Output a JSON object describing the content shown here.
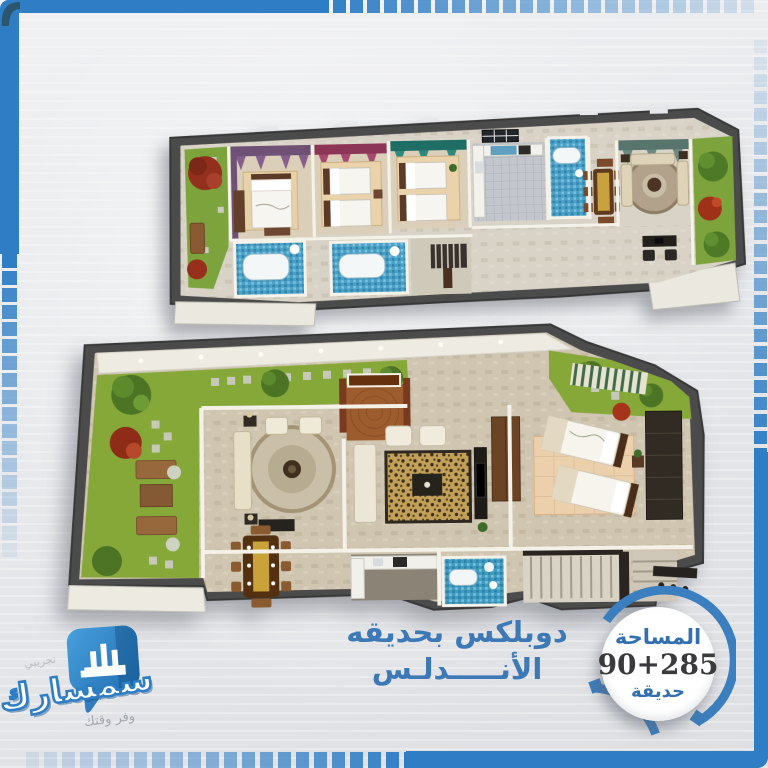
{
  "title": {
    "line1": "دوبلكس بحديقه",
    "line2": "الأنـــــدلـس"
  },
  "badge": {
    "area_label": "المساحة",
    "value": "90+285",
    "garden_label": "حديقة"
  },
  "logo": {
    "brand": "سمسارك",
    "tagline": "وفر وقتك",
    "trial_label": "تجريبي"
  },
  "palette": {
    "frame_blue": "#2f7dc5",
    "card_bg": "#e9eaec",
    "title_blue": "#3c79b6",
    "badge_ring_blue": "#3b7fc0",
    "badge_text_blue": "#3470b0",
    "badge_value_dark": "#3a3a3c",
    "logo_bubble_blue": "#2e7ec6",
    "tagline_gray": "#a2a8ae",
    "grass_green": "#85a839",
    "wall_dark": "#4b4b4b",
    "floor_beige": "#d2c9b5",
    "bathroom_blue": "#4aa0c6"
  }
}
